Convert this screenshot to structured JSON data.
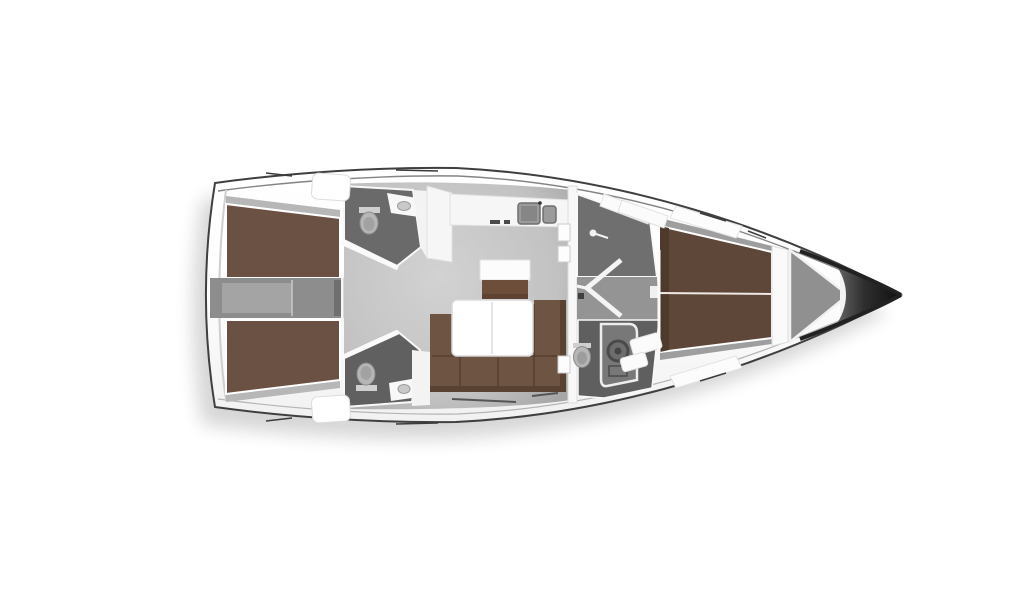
{
  "figure": {
    "kind": "sailing-yacht-interior-floor-plan",
    "view": "top-down",
    "orientation": "bow-right"
  },
  "colors": {
    "background": "#ffffff",
    "berth-brown": "#6b5143",
    "vberth-brown": "#5e4738",
    "sofa-brown": "#6e5443",
    "sofa-brown-dark": "#5a4232",
    "island-brown": "#6d4e3a",
    "corridor-gray": "#8d8d8d",
    "head-floor": "#6a6a6a",
    "vestibule-gray": "#949494",
    "wall-white": "#f8f8f8",
    "fixture-gray": "#b6b6b6",
    "sink-gray": "#9b9b9b",
    "hull-line": "#3f3f3f",
    "bow-dark": "#1c1c1c"
  },
  "plan": {
    "rooms": [
      "aft-cabin-port",
      "aft-cabin-starboard",
      "engine-corridor",
      "aft-head-port",
      "aft-head-starboard",
      "companionway",
      "galley",
      "salon",
      "forward-shower",
      "forward-head",
      "forward-cabin",
      "anchor-locker"
    ],
    "furniture": [
      "double-berth-port",
      "double-berth-starboard",
      "companionway-steps",
      "galley-counter",
      "galley-sinks",
      "island-seat",
      "salon-table",
      "u-shaped-sofa",
      "v-berth",
      "toilet",
      "washbasin",
      "shower-tray"
    ]
  }
}
